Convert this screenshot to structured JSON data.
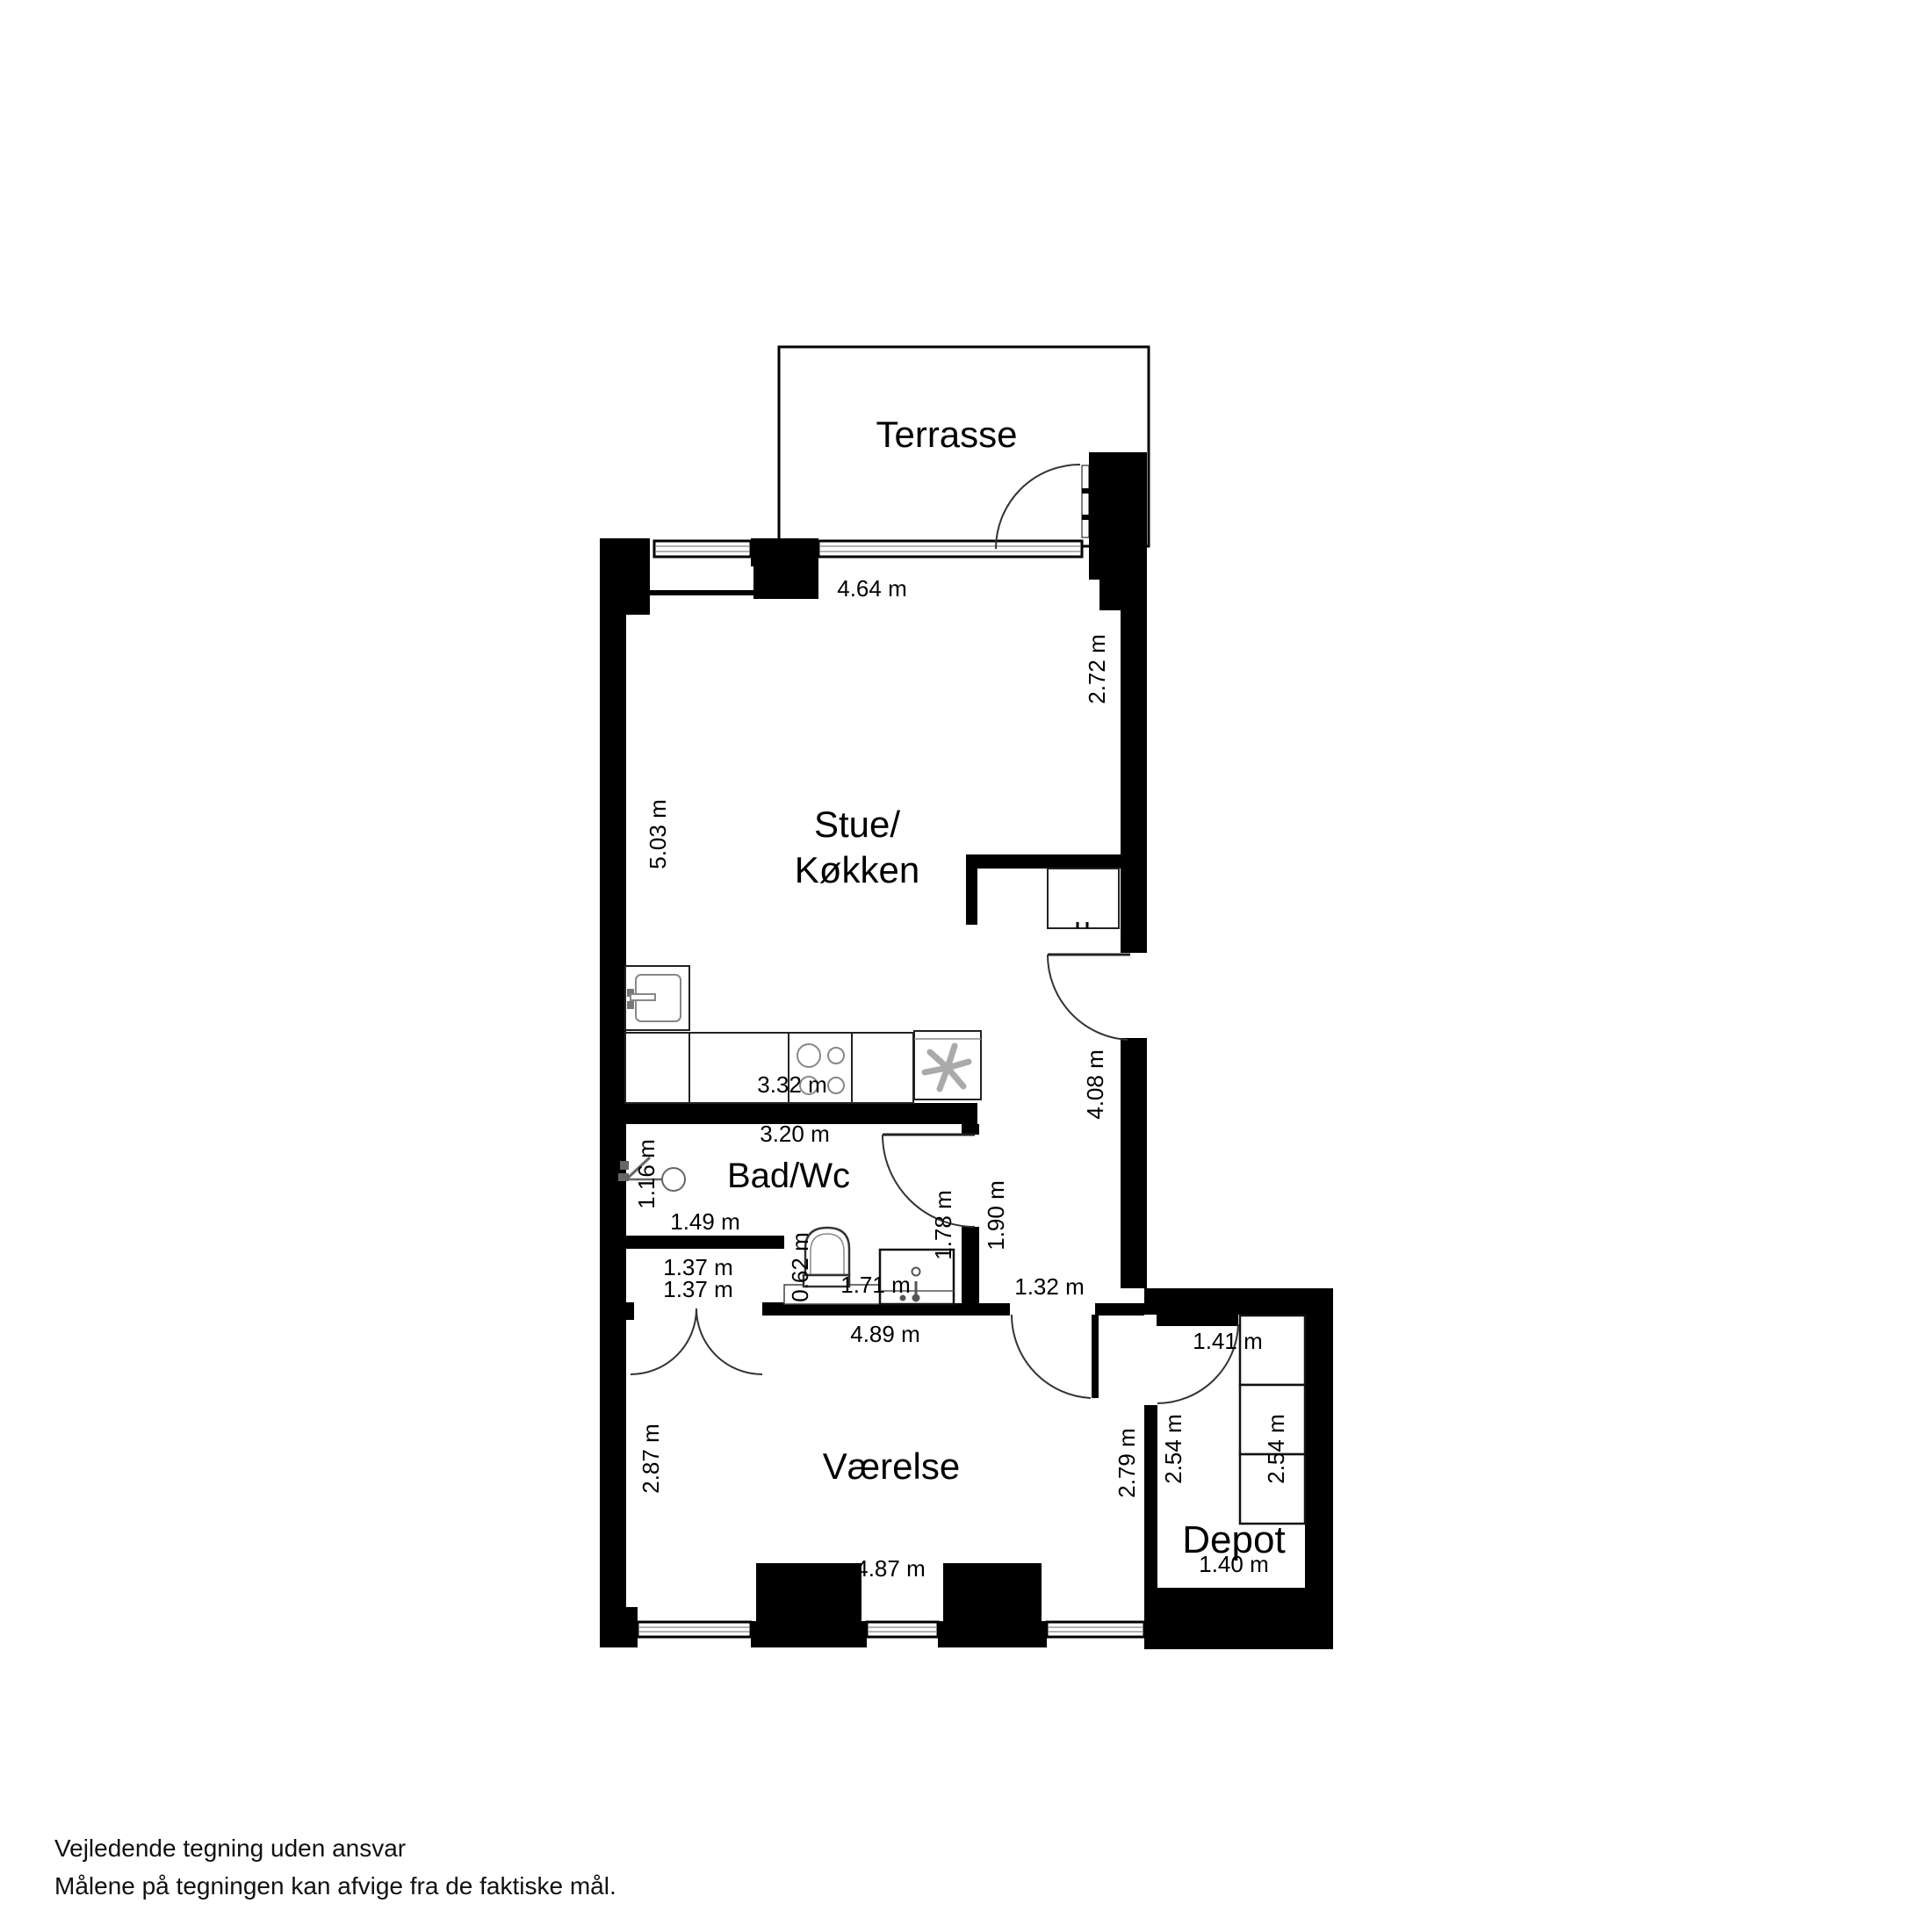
{
  "plan": {
    "rooms": {
      "terrace": "Terrasse",
      "living_line1": "Stue/",
      "living_line2": "Køkken",
      "bath": "Bad/Wc",
      "bedroom": "Værelse",
      "storage": "Depot"
    },
    "dimensions": {
      "top_window": "4.64 m",
      "living_right": "2.72 m",
      "living_left": "5.03 m",
      "kitchen_counter": "3.32 m",
      "bath_width": "3.20 m",
      "shower_side": "1.16 m",
      "bath_left": "1.49 m",
      "closet_upper": "1.37 m",
      "closet_lower": "1.37 m",
      "toilet_width": "0.62 m",
      "vanity_width": "1.71 m",
      "bath_door": "1.78 m",
      "hall_width": "1.90 m",
      "hall_lower": "1.32 m",
      "hall_height": "4.08 m",
      "bedroom_top": "4.89 m",
      "storage_door": "1.41 m",
      "bedroom_right": "2.79 m",
      "storage_left": "2.54 m",
      "storage_shelf": "2.54 m",
      "bedroom_left": "2.87 m",
      "bedroom_bottom": "4.87 m",
      "storage_width": "1.40 m"
    },
    "footer": {
      "line1": "Vejledende tegning uden ansvar",
      "line2": "Målene på tegningen kan afvige fra de faktiske mål."
    }
  }
}
